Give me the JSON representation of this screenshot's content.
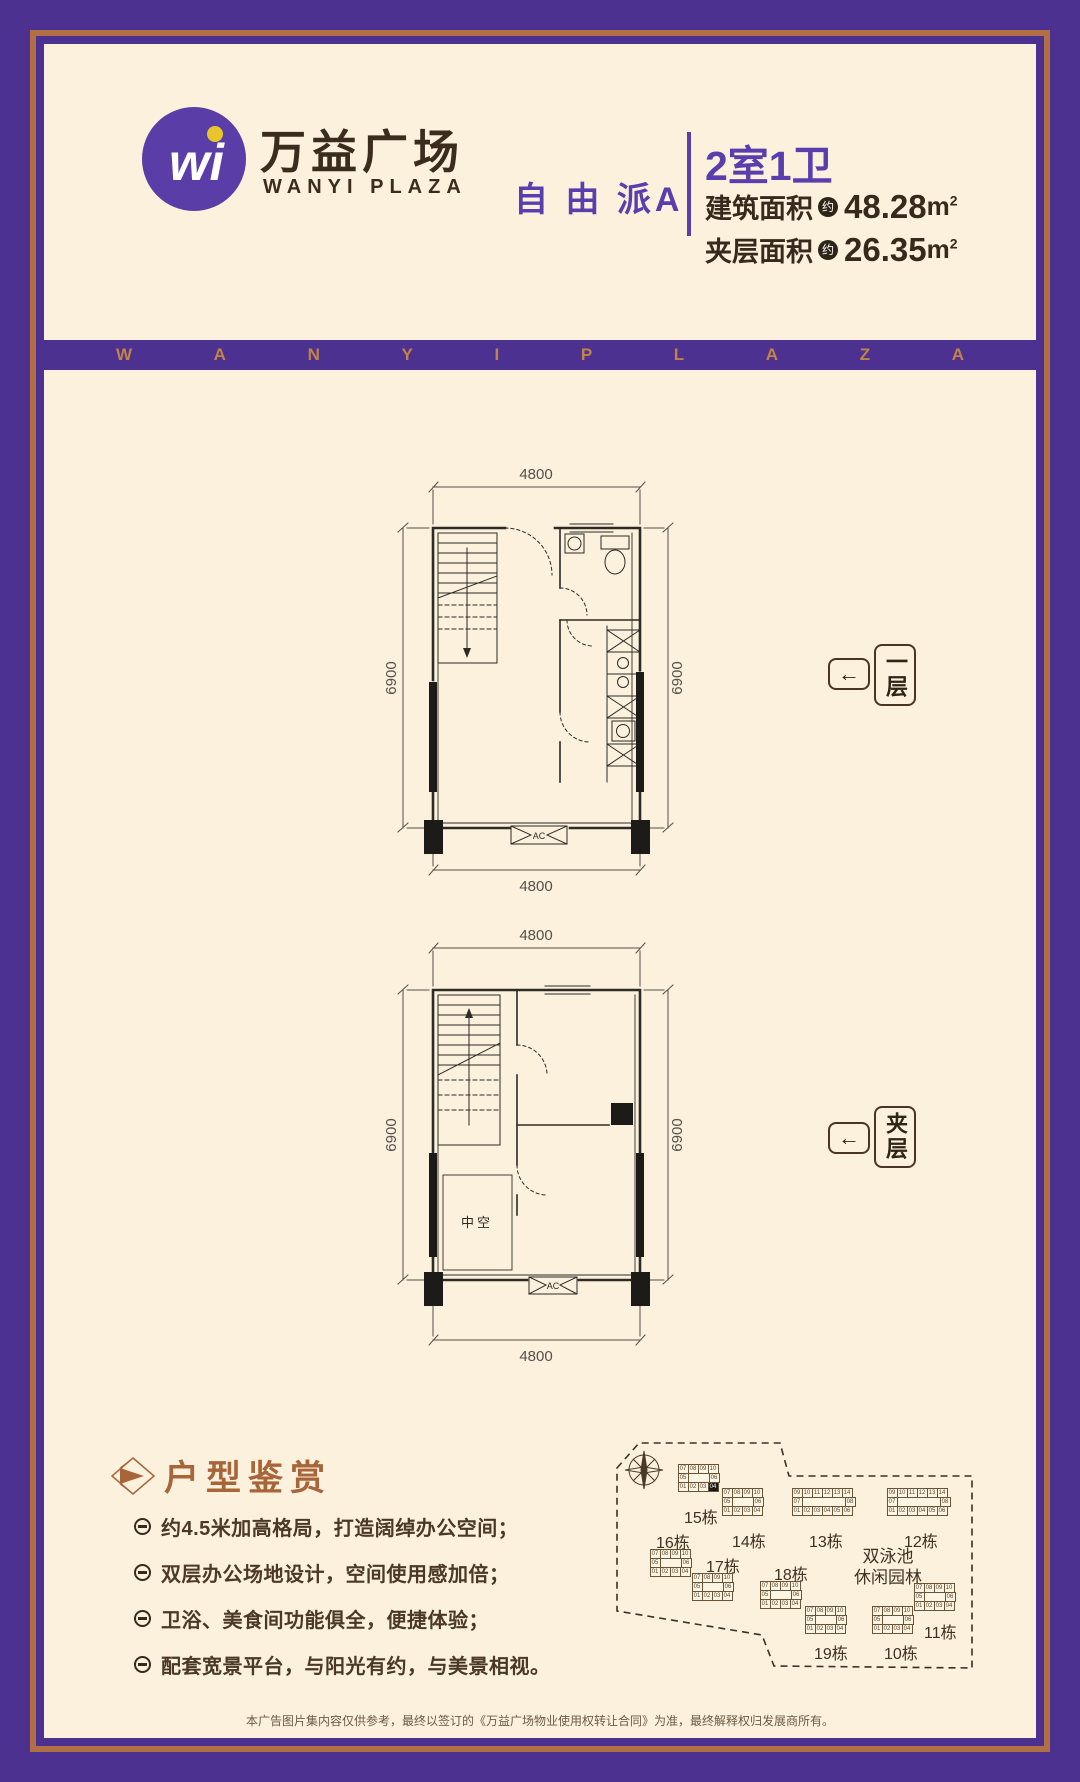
{
  "header": {
    "logo_monogram": "wi",
    "brand_cn": "万益广场",
    "brand_en": "WANYI PLAZA",
    "series": "自 由 派A",
    "unit_title": "2室1卫",
    "areas": [
      {
        "label": "建筑面积",
        "approx": "约",
        "value": "48.28",
        "unit": "m",
        "sup": "2"
      },
      {
        "label": "夹层面积",
        "approx": "约",
        "value": "26.35",
        "unit": "m",
        "sup": "2"
      }
    ]
  },
  "banner": {
    "letters": [
      "W",
      "A",
      "N",
      "Y",
      "I",
      "P",
      "L",
      "A",
      "Z",
      "A"
    ]
  },
  "plans": {
    "p1": {
      "top": "4800",
      "bottom": "4800",
      "left": "6900",
      "right": "6900",
      "ac": "AC",
      "arrow": "←",
      "tag": "一层"
    },
    "p2": {
      "top": "4800",
      "bottom": "4800",
      "left": "6900",
      "right": "6900",
      "ac": "AC",
      "arrow": "←",
      "tag": "夹层",
      "void": "中空"
    }
  },
  "features": {
    "title": "户型鉴赏",
    "items": [
      "约4.5米加高格局，打造阔绰办公空间；",
      "双层办公场地设计，空间使用感加倍；",
      "卫浴、美食间功能俱全，便捷体验；",
      "配套宽景平台，与阳光有约，与美景相视。"
    ]
  },
  "sitemap": {
    "pool_line1": "双泳池",
    "pool_line2": "休闲园林",
    "buildings": [
      {
        "name": "15栋",
        "x": 106,
        "y": 46,
        "lx": 112,
        "ly": 86,
        "hl": [
          2,
          3
        ],
        "rows": [
          "07 08 09 10",
          "05 _ 06",
          "01 02 03 04"
        ]
      },
      {
        "name": "14栋",
        "x": 150,
        "y": 70,
        "lx": 160,
        "ly": 110,
        "rows": [
          "07 08 09 10",
          "05 _ 06",
          "01 02 03 04"
        ]
      },
      {
        "name": "13栋",
        "x": 220,
        "y": 70,
        "lx": 237,
        "ly": 110,
        "rows": [
          "09 10 11 12 13 14",
          "07 _ 08",
          "01 02 03 04 05 06"
        ]
      },
      {
        "name": "12栋",
        "x": 315,
        "y": 70,
        "lx": 332,
        "ly": 110,
        "rows": [
          "09 10 11 12 13 14",
          "07 _ 08",
          "01 02 03 04 05 06"
        ]
      },
      {
        "name": "16栋",
        "x": 78,
        "y": 131,
        "lx": 84,
        "ly": 111,
        "rows": [
          "07 08 09 10",
          "05 _ 06",
          "01 02 03 04"
        ]
      },
      {
        "name": "17栋",
        "x": 120,
        "y": 155,
        "lx": 134,
        "ly": 135,
        "rows": [
          "07 08 09 10",
          "05 _ 06",
          "01 02 03 04"
        ]
      },
      {
        "name": "18栋",
        "x": 188,
        "y": 163,
        "lx": 202,
        "ly": 143,
        "rows": [
          "07 08 09 10",
          "05 _ 06",
          "01 02 03 04"
        ]
      },
      {
        "name": "19栋",
        "x": 233,
        "y": 188,
        "lx": 242,
        "ly": 222,
        "rows": [
          "07 08 09 10",
          "05 _ 06",
          "01 02 03 04"
        ]
      },
      {
        "name": "10栋",
        "x": 300,
        "y": 188,
        "lx": 312,
        "ly": 222,
        "rows": [
          "07 08 09 10",
          "05 _ 06",
          "01 02 03 04"
        ]
      },
      {
        "name": "11栋",
        "x": 342,
        "y": 165,
        "lx": 352,
        "ly": 201,
        "rows": [
          "07 08 09 10",
          "05 _ 06",
          "01 02 03 04"
        ]
      }
    ]
  },
  "footer": {
    "disclaimer": "本广告图片集内容仅供参考，最终以签订的《万益广场物业使用权转让合同》为准，最终解释权归发展商所有。"
  }
}
